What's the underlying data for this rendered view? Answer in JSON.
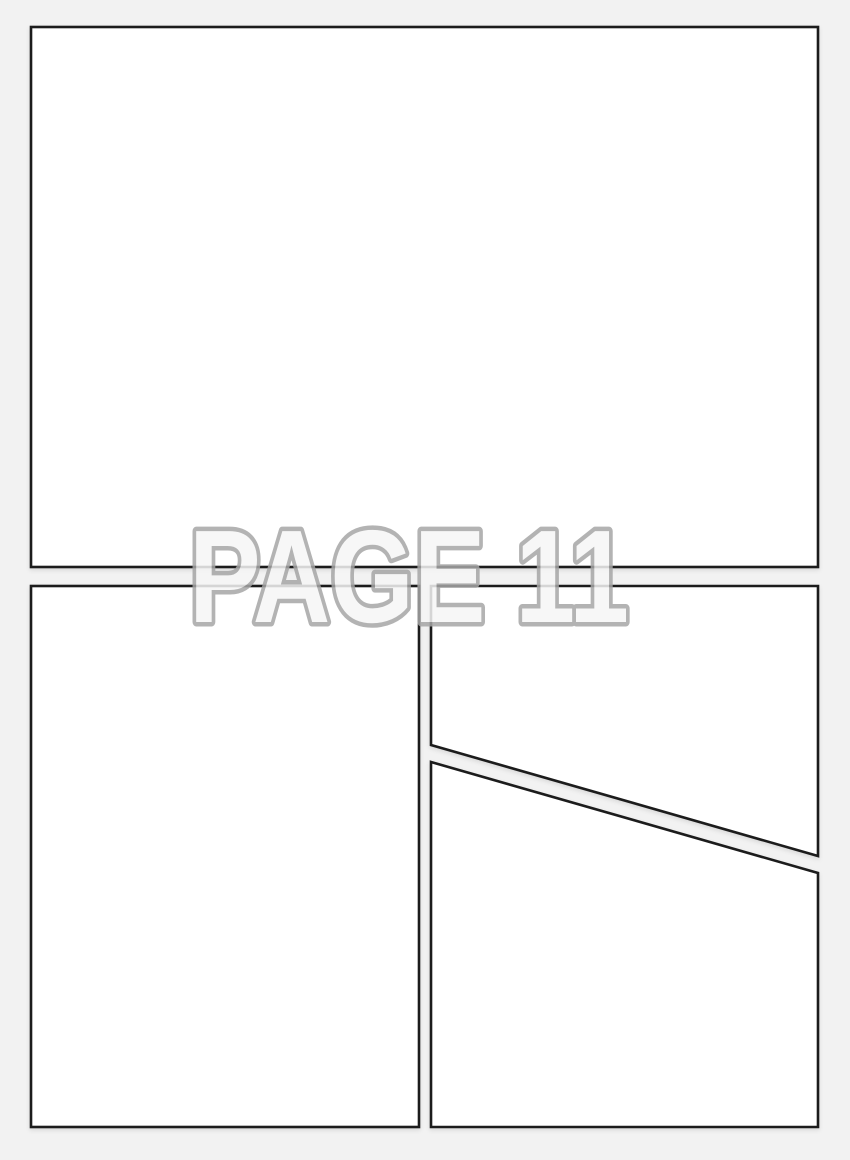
{
  "page": {
    "watermark_text": "PAGE 11",
    "colors": {
      "canvas_background": "#f2f2f2",
      "panel_fill": "#ffffff",
      "panel_border": "#1c1c1c",
      "gutter_color": "#f2f2f2",
      "watermark_fill": "#f6f6f6",
      "watermark_outline": "#a6a6a6"
    }
  }
}
